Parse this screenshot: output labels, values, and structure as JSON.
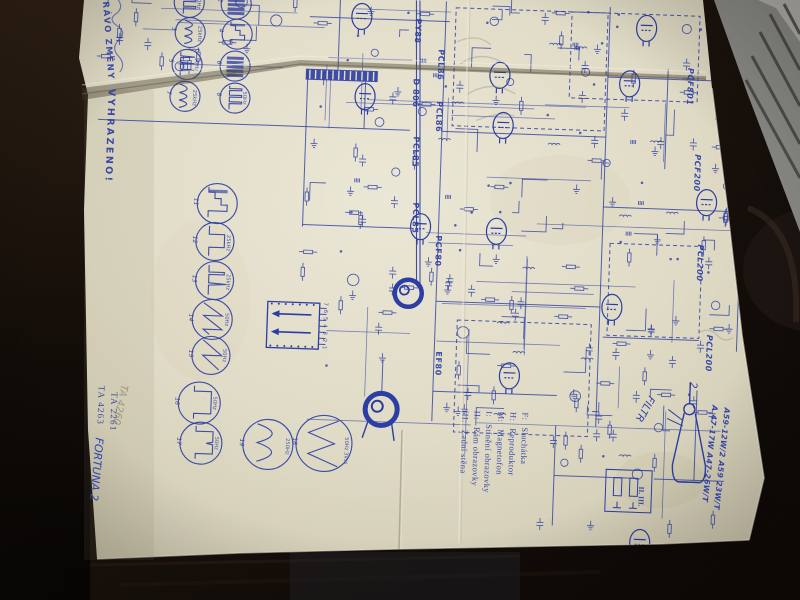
{
  "document": {
    "edge_notice": {
      "line1": "PRÁVO ZMĚNY",
      "line2": "VYHRAZENO!"
    },
    "type_numbers": {
      "ta_1": "TA 4263",
      "ta_2": "TA 2261"
    },
    "handwriting": {
      "model": "FORTUNA 2",
      "filter_note": "FILTR",
      "pencil_note": "TA 4260"
    },
    "tube_labels_main": [
      "PY88",
      "PCL86",
      "D 806",
      "PCL86",
      "PCL85",
      "PCL85",
      "PCF80",
      "EF80"
    ],
    "tube_labels_right": [
      "PCF801",
      "PCF200",
      "PCL200",
      "PCL200"
    ],
    "picture_tube": {
      "pin_label": "2",
      "types_line1": "A 47-17W  A47-26W/T",
      "types_line2": "A59-12W/2  A59 23W/T"
    },
    "connector_pins": "7 6 5 4 3 2 1",
    "section_marks": "II. III.",
    "legend": {
      "items": [
        {
          "key": "F:",
          "value": "Sluchátka"
        },
        {
          "key": "H:",
          "value": "Reproduktor"
        },
        {
          "key": "M:",
          "value": "Magnetofon"
        },
        {
          "key": "I:",
          "value": "Stínění obrazovky"
        },
        {
          "key": "II:",
          "value": "Rám obrazovky"
        },
        {
          "key": "III:",
          "value": "Zadní stěna"
        }
      ]
    },
    "oscillograms": {
      "items": [
        {
          "num": "1",
          "label": "50Hz"
        },
        {
          "num": "2",
          "label": ""
        },
        {
          "num": "3",
          "label": "25kHz"
        },
        {
          "num": "4",
          "label": ""
        },
        {
          "num": "5",
          "label": "50Hz"
        },
        {
          "num": "6",
          "label": ""
        },
        {
          "num": "7",
          "label": "25kHz"
        },
        {
          "num": "8",
          "label": "50Hz"
        },
        {
          "num": "11",
          "label": ""
        },
        {
          "num": "12",
          "label": "25kHz"
        },
        {
          "num": "13",
          "label": "25kHz"
        },
        {
          "num": "14",
          "label": "50Hz"
        },
        {
          "num": "15",
          "label": "50Hz"
        },
        {
          "num": "16",
          "label": "50Hz"
        },
        {
          "num": "17",
          "label": "50Hz"
        },
        {
          "num": "19",
          "label": "250Hz"
        },
        {
          "num": "18",
          "label": "50Hz 3Vss"
        }
      ]
    }
  },
  "colors": {
    "ink": "#2c3da3",
    "paper": "#e0dbc6",
    "desk_dark": "#16100a",
    "pencil_grey": "#8f8a78"
  }
}
